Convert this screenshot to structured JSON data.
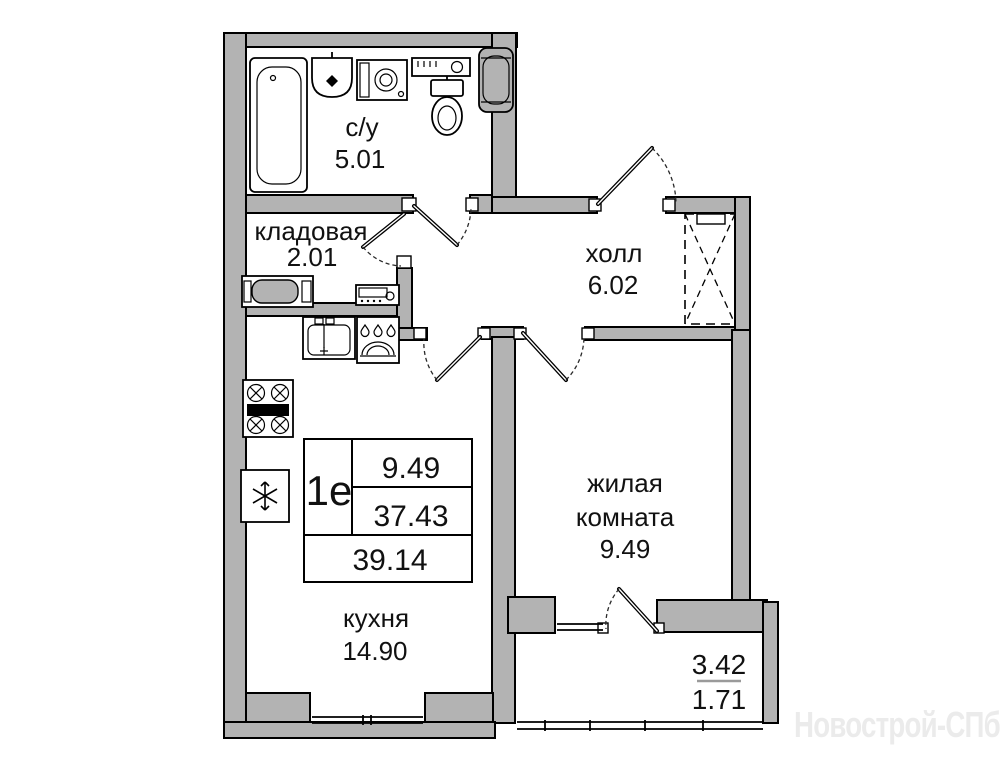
{
  "plan": {
    "rooms": {
      "bathroom": {
        "name": "с/у",
        "area": "5.01"
      },
      "storage": {
        "name": "кладовая",
        "area": "2.01"
      },
      "hall": {
        "name": "холл",
        "area": "6.02"
      },
      "living_room": {
        "name_lines": [
          "жилая",
          "комната"
        ],
        "area": "9.49"
      },
      "kitchen": {
        "name": "кухня",
        "area": "14.90"
      }
    },
    "info_table": {
      "unit_type": "1е",
      "living_area": "9.49",
      "apartment_area": "37.43",
      "total_area": "39.14"
    },
    "balcony": {
      "area_full": "3.42",
      "area_reduced": "1.71"
    },
    "icons": [
      "bathtub-icon",
      "washbasin-icon",
      "washing-machine-icon",
      "shelf-icon",
      "toilet-icon",
      "water-heater-icon",
      "cabinet-icon",
      "electric-panel-icon",
      "kitchen-sink-icon",
      "dishwasher-icon",
      "stove-icon",
      "fridge-icon",
      "wardrobe-placeholder"
    ],
    "colors": {
      "wall": "#b3b3b3",
      "line": "#000000",
      "background": "#ffffff",
      "watermark": "#ebebeb"
    }
  },
  "watermark": {
    "text": "Новострой-СПб"
  }
}
